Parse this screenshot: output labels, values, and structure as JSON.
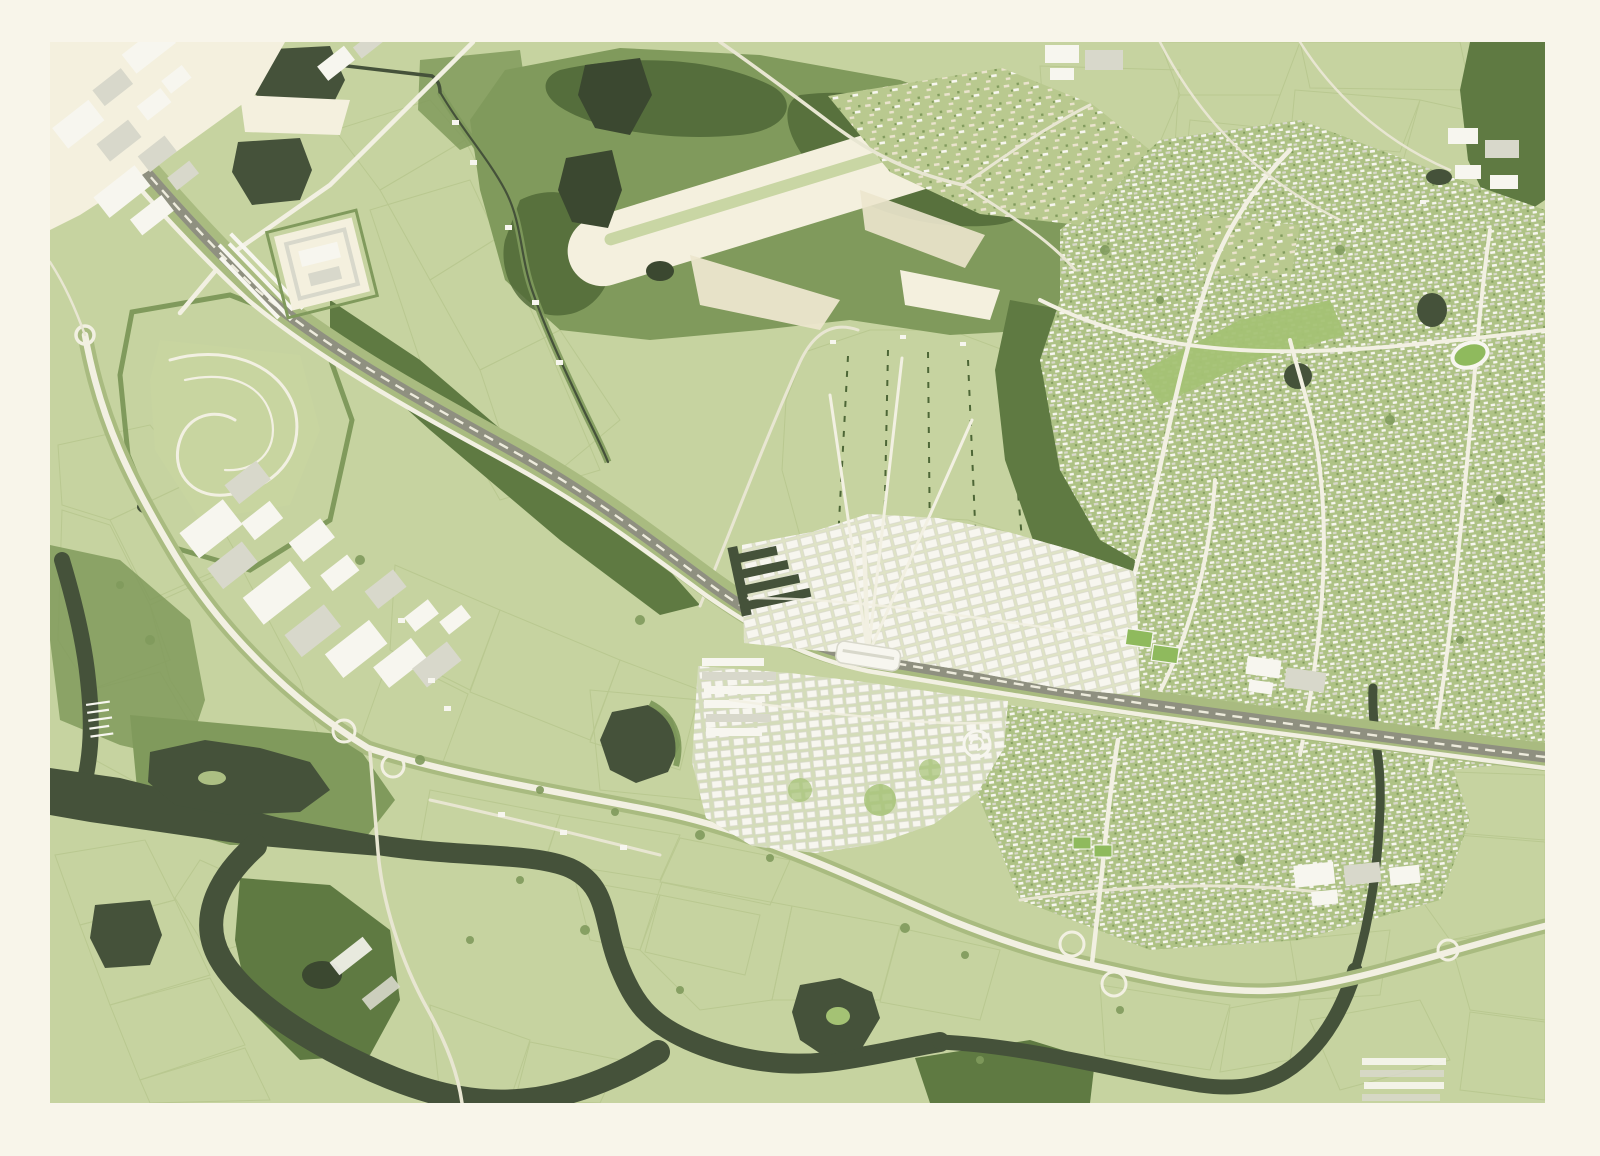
{
  "scene": {
    "type": "aerial-orthophoto-masterplan",
    "alt": "Green-toned aerial photograph: polder landscape with a meandering dark river and lakes in the south-west, a railway and motorway corridor crossing diagonally, a rendered new-town masterplan of white blocks around a central station, a dense existing city to the east, industrial estates, a heathland with sandy airstrip, a moated fort, and striped horticulture fields."
  },
  "features": [
    "paper-border",
    "map-canvas",
    "river",
    "river-meander",
    "northeast-canal",
    "oxbow-lake",
    "quarry-lakes",
    "heath-forest",
    "sandy-airstrip",
    "heath-lakes",
    "fort-compound",
    "landfill-park",
    "winding-stream",
    "rail-corridor",
    "existing-station",
    "masterplan-station",
    "masterplan-north-grid",
    "masterplan-south-grid",
    "harbor-basins",
    "radial-avenues",
    "observation-spiral",
    "sports-pitches",
    "city-east",
    "stadium",
    "city-ponds",
    "south-motorway",
    "interchange-west",
    "interchange-south",
    "interchange-east",
    "industrial-estate-west",
    "industrial-topleft",
    "industrial-river",
    "greenhouses",
    "swimming-lake",
    "beach",
    "marina",
    "wetland-forest",
    "fan-polder",
    "northeast-suburb",
    "allotments",
    "striped-fields"
  ],
  "colors": {
    "paper": "#f8f5ea",
    "mapBase": "#c6d3a0",
    "field1": "#d6dfb0",
    "field2": "#c8d5a0",
    "field3": "#b7cb8c",
    "field4": "#a4c274",
    "field5": "#8fba5d",
    "field6": "#e1e0bd",
    "sand": "#ece6cd",
    "sandLight": "#f4f0de",
    "forest": "#5f7a42",
    "forestDark": "#4d6636",
    "forestSoft": "#809a5c",
    "water": "#45523a",
    "waterDark": "#3b4830",
    "road": "#f2f0e2",
    "roadMinor": "#e8e6d2",
    "verge": "#a9bb80",
    "rail": "#8f9080",
    "railDash": "#edebdc",
    "bldg": "#f7f6ef",
    "bldgShade": "#d8d8cb",
    "suburbRoof": "#eae3cd",
    "urbanBase": "#aec285",
    "urbanBase2": "#b9c98f",
    "planGround": "#dfe3c6",
    "planGroundS": "#d4dcba",
    "seam": "#b9c890"
  }
}
